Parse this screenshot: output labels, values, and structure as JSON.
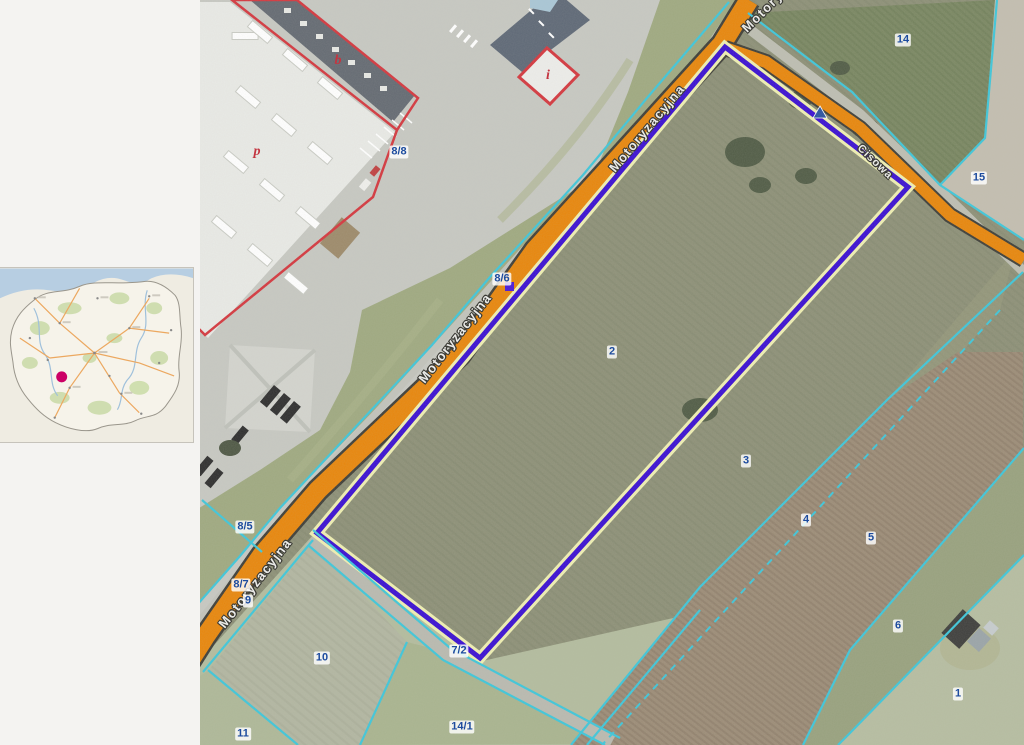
{
  "app": {
    "description": "Cadastral geoportal map view: orthophoto with parcel boundaries, highlighted parcel outline and Poland overview inset"
  },
  "inset": {
    "name": "poland-overview-map",
    "marker_color": "#CC0066"
  },
  "aerial": {
    "street_labels": [
      {
        "id": "street-top-partial",
        "text": "Motoryzacyjna"
      },
      {
        "id": "street-upper",
        "text": "Motoryzacyjna"
      },
      {
        "id": "street-middle",
        "text": "Motoryzacyjna"
      },
      {
        "id": "street-lower",
        "text": "Motoryzacyjna"
      },
      {
        "id": "street-side",
        "text": "Cisowa"
      }
    ],
    "parcel_labels": [
      {
        "text": "14"
      },
      {
        "text": "15"
      },
      {
        "text": "8/8"
      },
      {
        "text": "8/6"
      },
      {
        "text": "2"
      },
      {
        "text": "3"
      },
      {
        "text": "4"
      },
      {
        "text": "5"
      },
      {
        "text": "6"
      },
      {
        "text": "1"
      },
      {
        "text": "8/5"
      },
      {
        "text": "8/7"
      },
      {
        "text": "9"
      },
      {
        "text": "10"
      },
      {
        "text": "11"
      },
      {
        "text": "14/1"
      },
      {
        "text": "7/2"
      }
    ],
    "building_labels": [
      {
        "text": "b"
      },
      {
        "text": "p"
      },
      {
        "text": "i"
      }
    ],
    "colors": {
      "road_fill": "#E8860B",
      "road_casing": "#3E3E38",
      "highlight_parcel_outline": "#3A0FD2",
      "highlight_parcel_halo": "#EFEFB2",
      "cadastral_line": "#3EC6DA",
      "parcel_label_text": "#1C4B9E",
      "building_outline": "#D4373E"
    }
  }
}
